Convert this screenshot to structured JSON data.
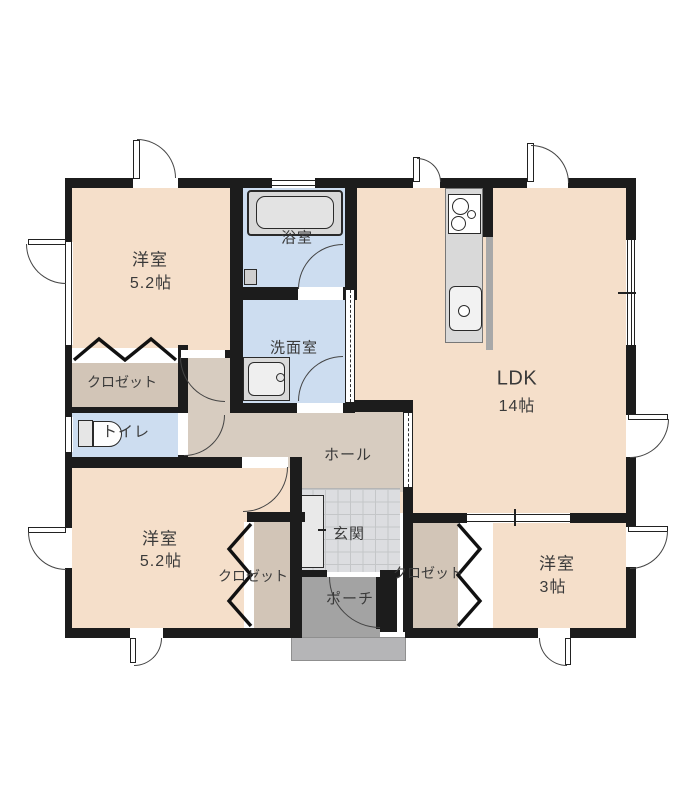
{
  "plan_title": "floor-plan",
  "colors": {
    "wall": "#1c1c1c",
    "room": "#f5dfca",
    "hall": "#d7ccc0",
    "closet": "#d2c5b7",
    "wet": "#cdddf0",
    "tile": "#dcdde0",
    "porch": "#a3a3a3",
    "step": "#b5b5b7",
    "counter": "#d9d9d9",
    "backsplash": "#a8a8a8",
    "text": "#3a3a3a"
  },
  "rooms": {
    "bedroom_top_left": {
      "name": "洋室",
      "size": "5.2帖"
    },
    "bathroom": {
      "name": "浴室"
    },
    "washroom": {
      "name": "洗面室"
    },
    "ldk": {
      "name": "LDK",
      "size": "14帖"
    },
    "closet_top_left": {
      "name": "クロゼット"
    },
    "toilet": {
      "name": "トイレ"
    },
    "hall": {
      "name": "ホール"
    },
    "entrance": {
      "name": "玄関"
    },
    "porch": {
      "name": "ポーチ"
    },
    "bedroom_bottom_left": {
      "name": "洋室",
      "size": "5.2帖"
    },
    "closet_bottom_left": {
      "name": "クロゼット"
    },
    "closet_bottom_right": {
      "name": "クロゼット"
    },
    "bedroom_bottom_right": {
      "name": "洋室",
      "size": "3帖"
    }
  },
  "fixtures": {
    "bathtub": "bathtub",
    "wash_basin": "wash-basin",
    "toilet_bowl": "toilet-bowl",
    "kitchen_stove": "kitchen-stove",
    "kitchen_sink": "kitchen-sink",
    "shoe_cabinet": "shoe-cabinet"
  }
}
